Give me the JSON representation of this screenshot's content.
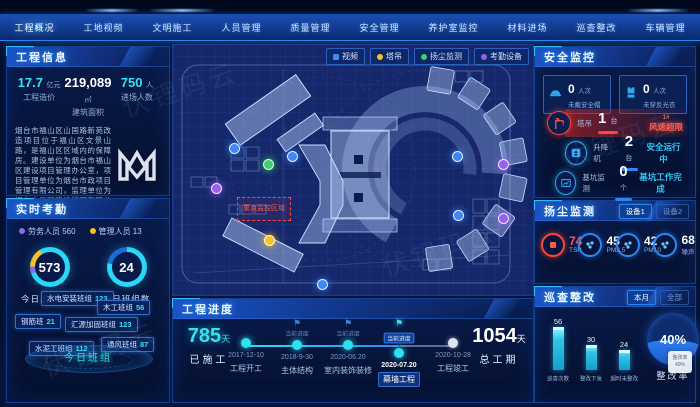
{
  "watermark": "伏锂码云",
  "nav": {
    "items": [
      "工程概况",
      "工地视频",
      "文明施工",
      "人员管理",
      "质量管理",
      "安全管理",
      "养护室监控",
      "材料进场",
      "巡查整改",
      "车辆管理"
    ],
    "active_index": 0
  },
  "project_info": {
    "title": "工程信息",
    "stats": [
      {
        "value": "17.7",
        "unit": "亿元",
        "label": "工程造价"
      },
      {
        "value": "219,089",
        "unit": "㎡",
        "label": "建筑面积"
      },
      {
        "value": "750",
        "unit": "人",
        "label": "进场人数"
      }
    ],
    "description": "烟台市福山区山国路新苑改造项目位于福山区文景山路，是福山区区域内的保障房。建设单位为烟台市福山区建设项目管理办公室，项目管理单位为烟台市政项目管理有限公司，监理单位为烟台市工程建设监理有限公司。",
    "logo_text": "M"
  },
  "attendance": {
    "title": "实时考勤",
    "legend": [
      {
        "label": "劳务人员",
        "value": "560",
        "color": "#8a6cf0"
      },
      {
        "label": "管理人员",
        "value": "13",
        "color": "#f5c324"
      }
    ],
    "donuts": [
      {
        "value": "573",
        "label": "今日出工人数"
      },
      {
        "value": "24",
        "label": "今日班组数"
      }
    ],
    "teams": [
      {
        "name": "水电安装班组",
        "count": "123",
        "x": 34,
        "y": 92
      },
      {
        "name": "木工班组",
        "count": "56",
        "x": 90,
        "y": 101
      },
      {
        "name": "钢筋班",
        "count": "21",
        "x": 8,
        "y": 115
      },
      {
        "name": "汇源加固班组",
        "count": "123",
        "x": 58,
        "y": 118
      },
      {
        "name": "水泥工班组",
        "count": "112",
        "x": 22,
        "y": 142
      },
      {
        "name": "通风班组",
        "count": "87",
        "x": 94,
        "y": 138
      }
    ],
    "center_label": "今日班组"
  },
  "map": {
    "filters": [
      {
        "label": "视频",
        "color": "#3f87f5",
        "shape": "square"
      },
      {
        "label": "塔吊",
        "color": "#f5c324",
        "shape": "dot"
      },
      {
        "label": "扬尘监测",
        "color": "#3fd06b",
        "shape": "dot"
      },
      {
        "label": "考勤设备",
        "color": "#9a5ff0",
        "shape": "dot"
      }
    ],
    "markers": [
      {
        "x": 56,
        "y": 84,
        "color": "#3f87f5",
        "type": "视频"
      },
      {
        "x": 114,
        "y": 92,
        "color": "#3f87f5",
        "type": "视频"
      },
      {
        "x": 279,
        "y": 92,
        "color": "#3f87f5",
        "type": "视频"
      },
      {
        "x": 280,
        "y": 151,
        "color": "#3f87f5",
        "type": "视频"
      },
      {
        "x": 144,
        "y": 220,
        "color": "#3f87f5",
        "type": "视频"
      },
      {
        "x": 90,
        "y": 100,
        "color": "#3fd06b",
        "type": "扬尘监测"
      },
      {
        "x": 38,
        "y": 124,
        "color": "#9a5ff0",
        "type": "考勤设备"
      },
      {
        "x": 325,
        "y": 100,
        "color": "#9a5ff0",
        "type": "考勤设备"
      },
      {
        "x": 325,
        "y": 154,
        "color": "#9a5ff0",
        "type": "考勤设备"
      },
      {
        "x": 91,
        "y": 176,
        "color": "#f5c324",
        "type": "塔吊"
      }
    ],
    "red_zone_label": "重点监控区域"
  },
  "progress": {
    "title": "工程进度",
    "done": {
      "value": "785",
      "unit": "天",
      "label": "已施工"
    },
    "total": {
      "value": "1054",
      "unit": "天",
      "label": "总工期"
    },
    "milestones": [
      {
        "date": "2017-12-10",
        "label": "工程开工",
        "state": "done",
        "flag": false,
        "caption": ""
      },
      {
        "date": "2018-9-30",
        "label": "主体结构",
        "state": "done",
        "flag": true,
        "caption": "当前进度"
      },
      {
        "date": "2020-06.20",
        "label": "室内装饰装修",
        "state": "done",
        "flag": true,
        "caption": "当前进度"
      },
      {
        "date": "2020-07.20",
        "label": "幕墙工程",
        "state": "current",
        "flag": true,
        "caption": "当前进度"
      },
      {
        "date": "2020-10-28",
        "label": "工程竣工",
        "state": "future",
        "flag": false,
        "caption": ""
      }
    ]
  },
  "safety": {
    "title": "安全监控",
    "boxes": [
      {
        "value": "0",
        "unit": "人次",
        "label": "未戴安全帽",
        "icon": "helmet-icon"
      },
      {
        "value": "0",
        "unit": "人次",
        "label": "未穿反光衣",
        "icon": "vest-icon"
      }
    ],
    "rows": [
      {
        "label": "塔吊",
        "value": "1",
        "unit": "台",
        "note": "1#",
        "status": "风速超限",
        "type": "alert",
        "icon": "crane-icon",
        "indent": 4
      },
      {
        "label": "升降机",
        "value": "2",
        "unit": "台",
        "note": "",
        "status": "安全运行中",
        "type": "ok",
        "icon": "hoist-icon",
        "indent": 22
      },
      {
        "label": "基坑监测",
        "value": "0",
        "unit": "个",
        "note": "",
        "status": "基坑工作完成",
        "type": "ok",
        "icon": "pit-monitor-icon",
        "indent": 12
      }
    ]
  },
  "dust": {
    "title": "扬尘监测",
    "tabs": [
      {
        "label": "设备1",
        "active": true
      },
      {
        "label": "设备2",
        "active": false
      }
    ],
    "metrics": [
      {
        "value": "74",
        "label": "TSP",
        "alert": true
      },
      {
        "value": "45",
        "label": "PM2.5",
        "alert": false
      },
      {
        "value": "42",
        "label": "PM10",
        "alert": false
      },
      {
        "value": "68",
        "label": "噪声",
        "alert": false
      }
    ]
  },
  "inspection": {
    "title": "巡查整改",
    "tabs": [
      {
        "label": "本月",
        "active": true
      },
      {
        "label": "全部",
        "active": false
      }
    ],
    "chart_data": {
      "type": "bar",
      "categories": [
        "巡查次数",
        "整改下发",
        "超时未整改"
      ],
      "values": [
        56,
        30,
        24
      ],
      "title": "巡查整改（本月）",
      "xlabel": "",
      "ylabel": "",
      "ylim": [
        0,
        60
      ],
      "grid": false,
      "legend_position": "none"
    },
    "gauge": {
      "value": "40%",
      "label": "整改率"
    },
    "tooltip": {
      "line1": "整改率",
      "line2": "40%"
    }
  }
}
